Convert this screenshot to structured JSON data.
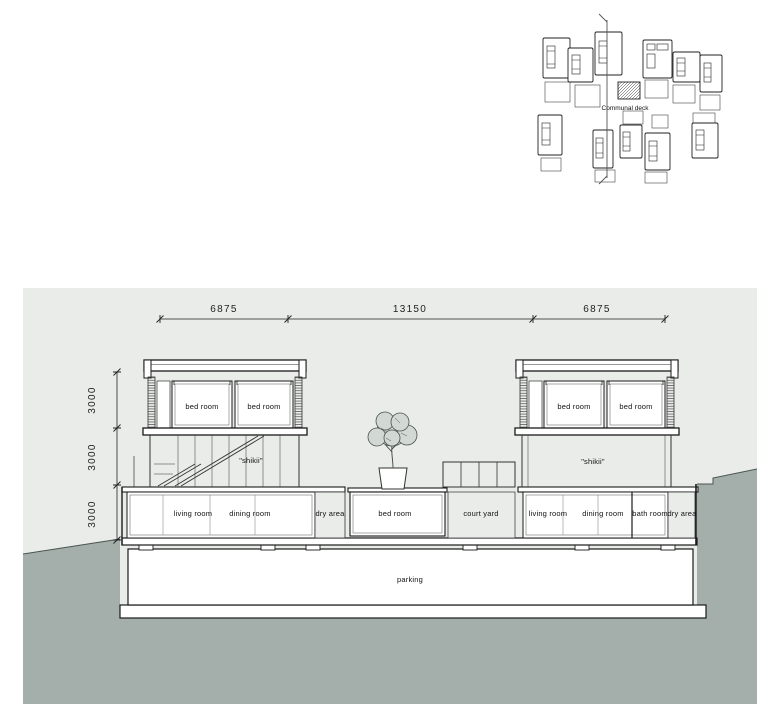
{
  "plan": {
    "communal_deck_label": "Communal deck"
  },
  "dimensions": {
    "horizontal": [
      "6875",
      "13150",
      "6875"
    ],
    "vertical": [
      "3000",
      "3000",
      "3000"
    ]
  },
  "rooms": {
    "bed_room": "bed room",
    "shikii": "\"shikii\"",
    "living_room": "living room",
    "dining_room": "dining room",
    "dry_area": "dry area",
    "bath_room": "bath room",
    "court_yard": "court yard",
    "parking": "parking"
  },
  "colors": {
    "panel_background": "#e9ece9",
    "ground": "#a4afab",
    "ground_edge": "#4a5450",
    "line": "#222222",
    "foliage_fill": "#d2d8d4"
  }
}
